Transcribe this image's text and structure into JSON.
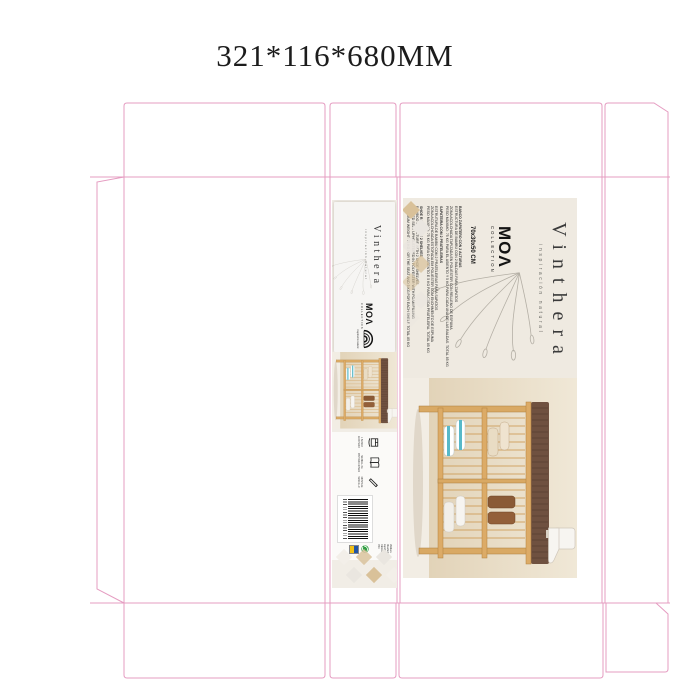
{
  "title": "321*116*680MM",
  "brand": {
    "wordmark": "Vinthera",
    "tagline": "inspiración natural",
    "moa_logo": "MOΛ",
    "moa_sub": "COLLECTION",
    "rainbow_caption": "inspiración natural"
  },
  "main_panel": {
    "size_heading": "70x30x50 CM",
    "blocks": [
      {
        "header": "BANCO ZAPATERO CON 2 ALTURAS",
        "line1": "ESTRUCTURA DE BAMBÚ CON 2 BALDAS PARA ZAPATOS",
        "line2": "ZONA ACOLCHADA TAPIZADA EN POLIÉSTER CON RELLENO DE ESPUMA",
        "line3": "PESO MÁXIMO: 75 KG PARA EL ASIENTO Y 5 KG PARA CADA UNA DE LAS BALDAS. TOTAL 85 KG"
      },
      {
        "header": "SAPATEIRA COM 2 PRATELEIRAS",
        "line1": "ESTRUTURA DE BAMBU COM 2 PRATELEIRAS PARA SAPATOS",
        "line2": "ZONA ACOLCHOADA ESTOFADA EM POLIÉSTER COM ENCHIMENTO DE ESPUMA",
        "line3": "PESO MÁXIMO: 75 KG PARA O ASSENTO E 5 KG PARA CADA PRATELEIRA. TOTAL 85 KG"
      },
      {
        "header": "SHOE RACK WITH 2 SHELVES",
        "line1": "BAMBOO STRUCTURE WITH 2 SHOE SHELVES",
        "line2": "PADDED SEAT UPHOLSTERED IN POLYESTER WITH FOAM FILLING",
        "line3": "MAXIMUM WEIGHT: 75 KG FOR THE SEAT AND 5 KG FOR EACH SHELF. TOTAL 85 KG"
      }
    ]
  },
  "side_panel": {
    "icon_captions": {
      "contents": "1 BANCO ZAPATERO",
      "manual": "MANUAL DE INSTRUCCIONES",
      "assembly": "MONTAJE SENCILLO"
    },
    "company_lines": {
      "l1": "Vinthera",
      "l2": "Diseñado en España",
      "l3": "Fabricado en PRC"
    }
  },
  "colors": {
    "dieline": "#e59cc1",
    "diamond_beige": "#d9c199",
    "bamboo": "#d9a964",
    "cushion": "#6f5140",
    "teal_accent": "#57b9c9",
    "green_label": "#2f9e41",
    "blue_label": "#2256a5",
    "yellow_label": "#f2c118"
  }
}
